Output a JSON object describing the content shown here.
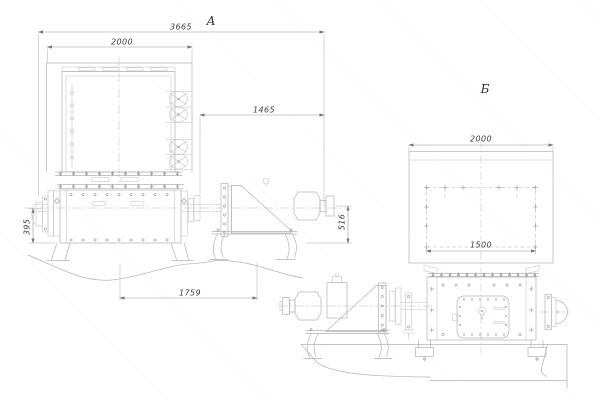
{
  "views": {
    "a": {
      "label": "А",
      "dims": {
        "overall_length": "3665",
        "hopper_width": "2000",
        "drive_length": "1465",
        "axis_height": "395",
        "base_length": "1759",
        "drive_height": "516"
      }
    },
    "b": {
      "label": "Б",
      "dims": {
        "hopper_width": "2000",
        "bolt_field_width": "1500"
      }
    }
  },
  "colors": {
    "background": "#ffffff",
    "line": "#b3b3b5",
    "dimension_line": "#98989a",
    "text": "#3d3d3d"
  }
}
